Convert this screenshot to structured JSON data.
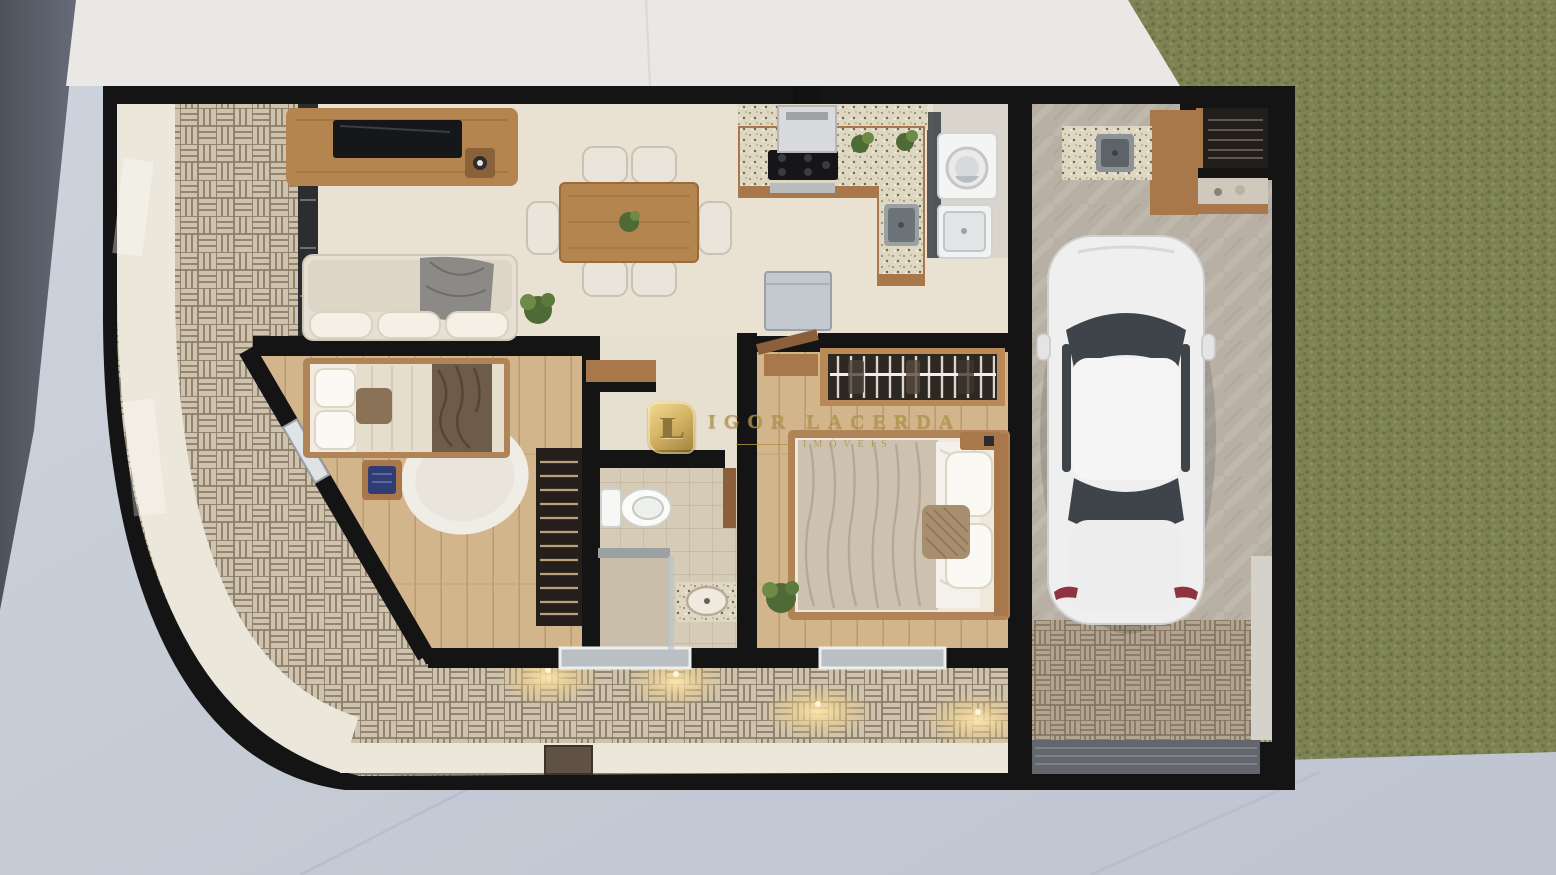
{
  "watermark": {
    "monogram": "IL",
    "brand": "IGOR LACERDA",
    "subtitle": "IMÓVEIS"
  },
  "palette": {
    "street_asphalt": "#565b66",
    "public_sidewalk": "#c7ccd6",
    "front_slab": "#e9e8e4",
    "lawn_grass": "#7d8354",
    "wall_black": "#141414",
    "floor_cream": "#e9e1d2",
    "floor_wood": "#d3b58c",
    "floor_garage": "#b8b0a5",
    "floor_bath_tile": "#d5cbb7",
    "brick_paving": "#cfc3ad",
    "brick_joint": "#8a7d69",
    "driveway_paver": "#b2a48f",
    "furniture_wood": "#b5854f",
    "granite_counter": "#ded7c1",
    "sofa_cream": "#e6e0d4",
    "car_body": "#efefef",
    "car_glass": "#3f444b",
    "watermark_gold": "#b2924a",
    "light_glow": "#ffe7ae"
  }
}
